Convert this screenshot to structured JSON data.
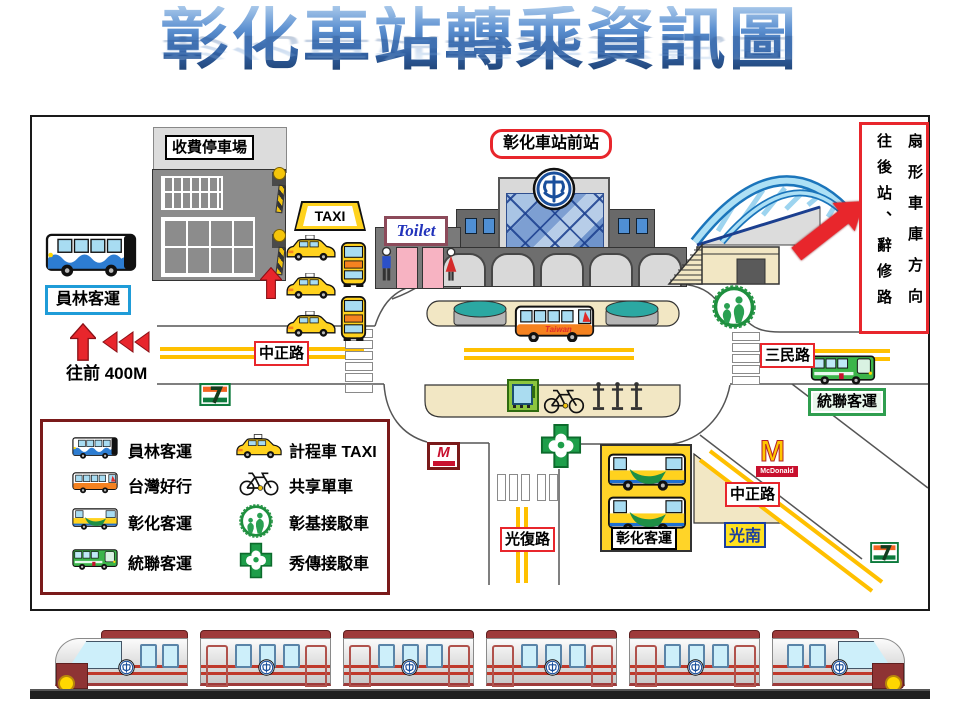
{
  "title": "彰化車站轉乘資訊圖",
  "map": {
    "parking_label": "收費停車場",
    "station_front_label": "彰化車站前站",
    "taxi_sign": "TAXI",
    "toilet_sign": "Toilet",
    "yuanlin_stop_label": "員林客運",
    "walk_forward_label": "往前 400M",
    "road_zhongzheng_west": "中正路",
    "road_zhongzheng_east": "中正路",
    "road_sanmin": "三民路",
    "road_guangfu": "光復路",
    "ubus_stop_label": "統聯客運",
    "changhua_bus_terminal_label": "彰化客運",
    "kuangnan_sign": "光南",
    "mcdonalds_sign": "McDonald",
    "taiwan_bus_text": "Taiwan",
    "rear_exit_box": {
      "left_column": "往後站、辭修路",
      "right_column": "扇形車庫方向"
    }
  },
  "legend": {
    "items": [
      {
        "icon": "yuanlin-bus-icon",
        "label": "員林客運"
      },
      {
        "icon": "taiwan-trip-bus-icon",
        "label": "台灣好行"
      },
      {
        "icon": "changhua-bus-icon",
        "label": "彰化客運"
      },
      {
        "icon": "ubus-icon",
        "label": "統聯客運"
      },
      {
        "icon": "taxi-icon",
        "label": "計程車 TAXI"
      },
      {
        "icon": "shared-bike-icon",
        "label": "共享單車"
      },
      {
        "icon": "cch-shuttle-icon",
        "label": "彰基接駁車"
      },
      {
        "icon": "show-chwan-shuttle-icon",
        "label": "秀傳接駁車"
      }
    ]
  },
  "colors": {
    "road_marking": "#FFC000",
    "arrow_red": "#E8262C",
    "label_border_red": "#E8262C",
    "island_tan": "#F2E7C4",
    "bridge_blue": "#ADE0F5",
    "train_maroon": "#9E3B3B",
    "tra_blue": "#1A4F9C"
  }
}
